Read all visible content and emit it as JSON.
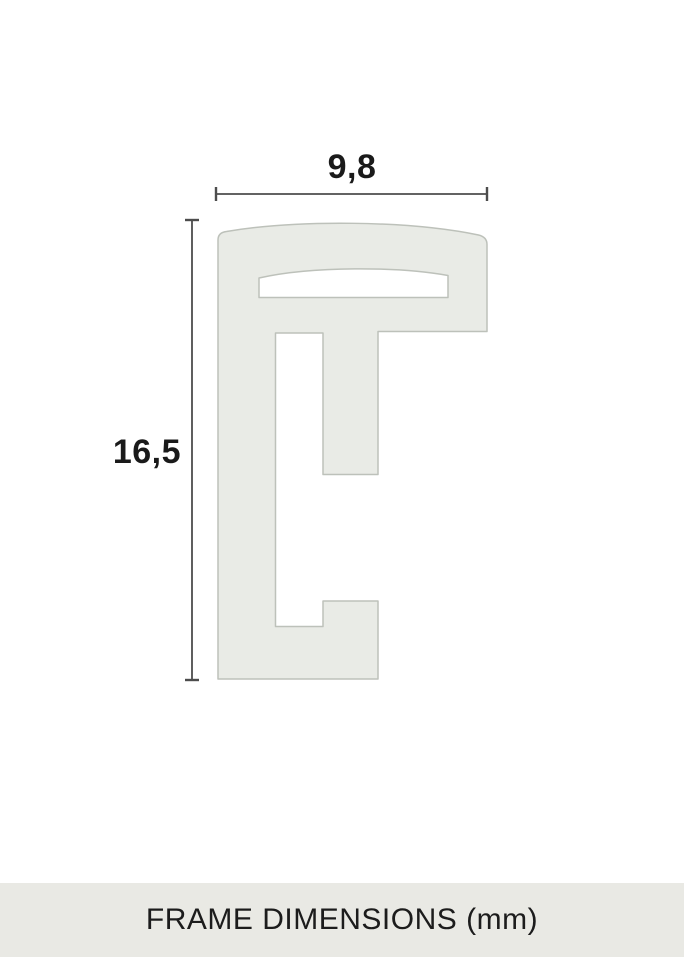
{
  "diagram": {
    "width_dimension": {
      "label": "9,8"
    },
    "height_dimension": {
      "label": "16,5"
    },
    "caption": "FRAME DIMENSIONS (mm)",
    "units": "mm",
    "colors": {
      "background": "#ffffff",
      "shape_fill": "#e9ebe6",
      "shape_stroke": "#bdc1ba",
      "slot_fill": "#ffffff",
      "dimension_line": "#4d4d4d",
      "label_text": "#1a1a1a",
      "caption_band": "#e9e9e4",
      "caption_text": "#1c1c1c"
    }
  }
}
